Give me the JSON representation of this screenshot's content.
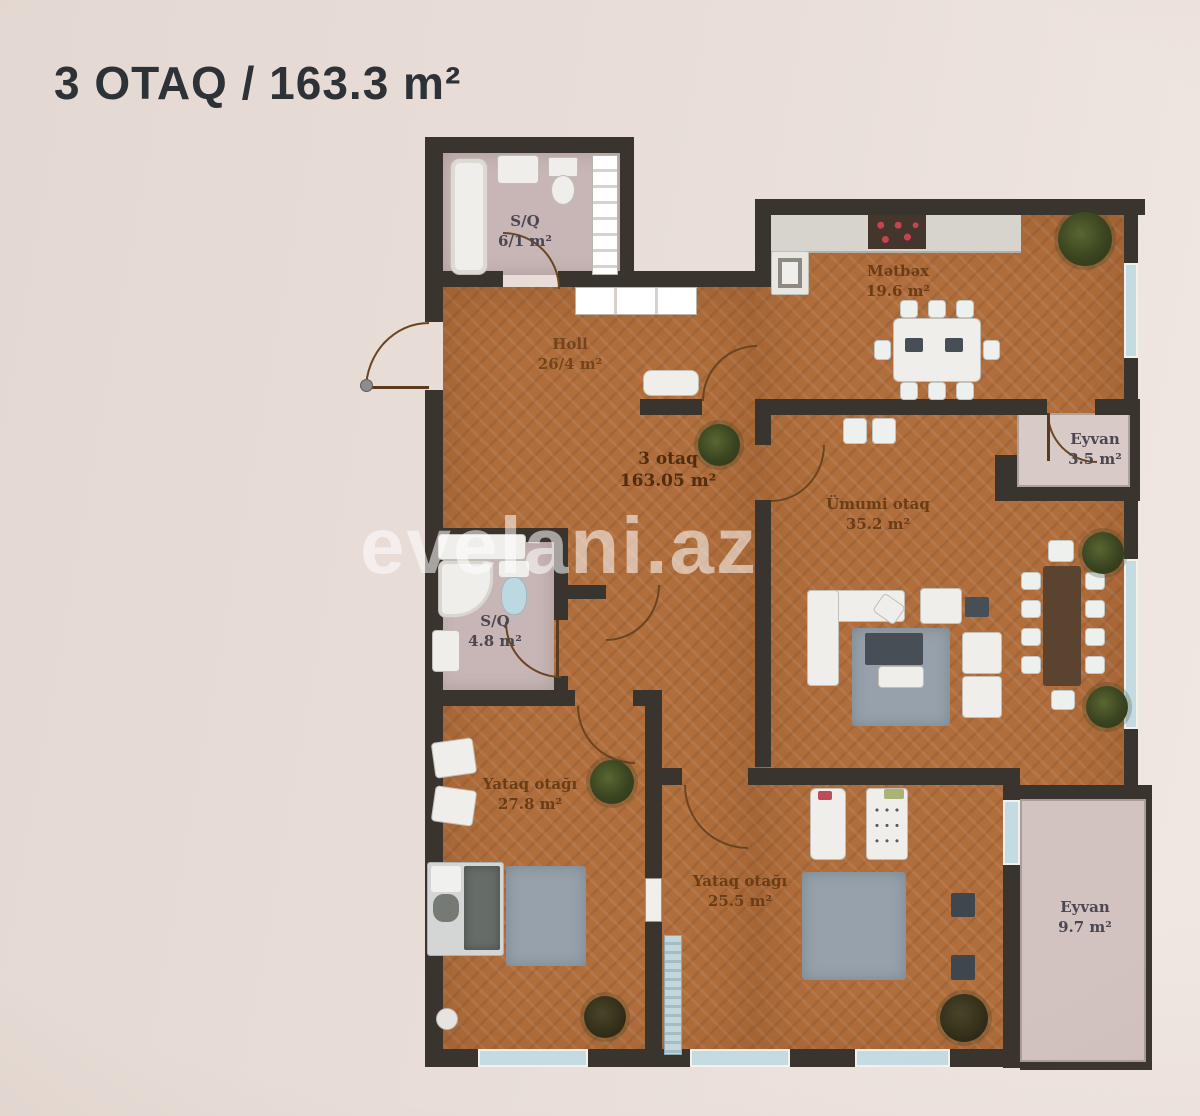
{
  "title": "3 OTAQ / 163.3 m²",
  "watermark": "evelani.az",
  "plan": {
    "unit": {
      "name": "3 otaq",
      "area": "163.05 m²"
    },
    "rooms": [
      {
        "id": "bathroom-top",
        "name": "S/Q",
        "area": "6/1 m²"
      },
      {
        "id": "hall",
        "name": "Holl",
        "area": "26/4 m²"
      },
      {
        "id": "kitchen",
        "name": "Mətbəx",
        "area": "19.6 m²"
      },
      {
        "id": "living-room",
        "name": "Ümumi otaq",
        "area": "35.2 m²"
      },
      {
        "id": "balcony-small",
        "name": "Eyvan",
        "area": "3.5 m²"
      },
      {
        "id": "bathroom-small",
        "name": "S/Q",
        "area": "4.8 m²"
      },
      {
        "id": "bedroom-1",
        "name": "Yataq otağı",
        "area": "27.8 m²"
      },
      {
        "id": "bedroom-2",
        "name": "Yataq otağı",
        "area": "25.5 m²"
      },
      {
        "id": "balcony-large",
        "name": "Eyvan",
        "area": "9.7 m²"
      }
    ]
  },
  "colors": {
    "background": "#e9ded8",
    "walls": "#3a342e",
    "wood_floor": "#b06e3c",
    "bathroom_floor": "#c7b6b5",
    "balcony_floor": "#d7cac7",
    "stove_burners": "#c4454f",
    "rug": "#97a1ab",
    "title_text": "#2d3236",
    "label_text": "#6a3d16",
    "watermark_text": "rgba(255,255,255,0.55)"
  }
}
